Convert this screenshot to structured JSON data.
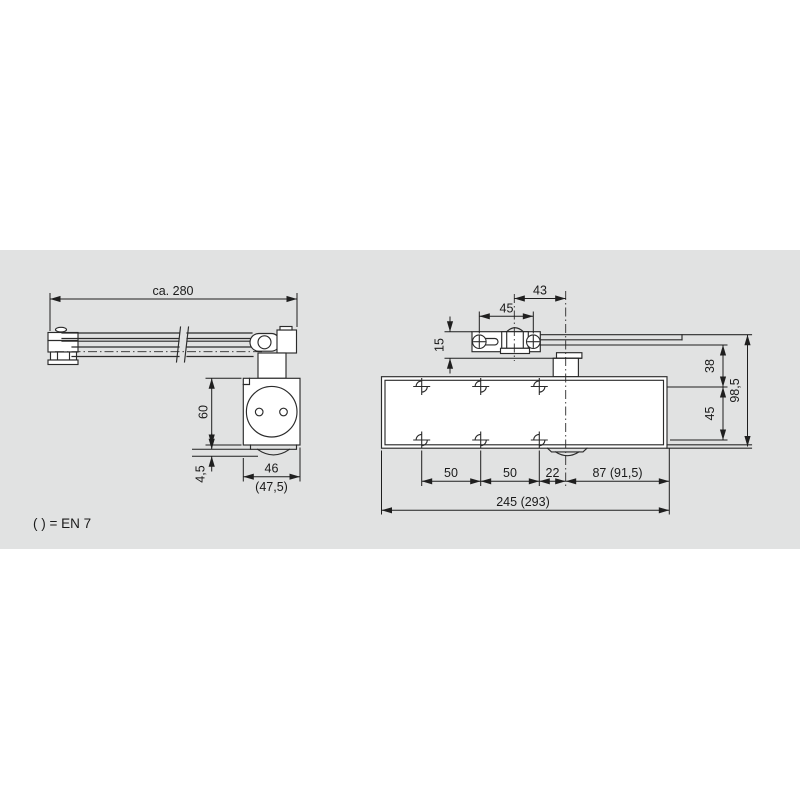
{
  "drawing_title": "door-closer-dimension-drawing",
  "colors": {
    "background": "#ffffff",
    "panel": "#e1e2e2",
    "line": "#2b2b2b",
    "text": "#1a1a1a"
  },
  "side_view": {
    "dims": {
      "overall_length": "ca. 280",
      "body_height": "60",
      "plate_thickness": "4,5",
      "body_width": "46",
      "body_width_en7": "(47,5)"
    }
  },
  "front_view": {
    "dims": {
      "pivot_to_spindle": "43",
      "bracket_hole_spacing": "45",
      "bracket_offset": "15",
      "arm_to_screw_row": "38",
      "screw_row_spacing": "45",
      "total_height": "98,5",
      "hole_pitch_1": "50",
      "hole_pitch_2": "50",
      "hole_to_axis": "22",
      "axis_to_body_end": "87 (91,5)",
      "body_length": "245 (293)"
    }
  },
  "legend": {
    "en7_note": "( ) = EN 7"
  }
}
